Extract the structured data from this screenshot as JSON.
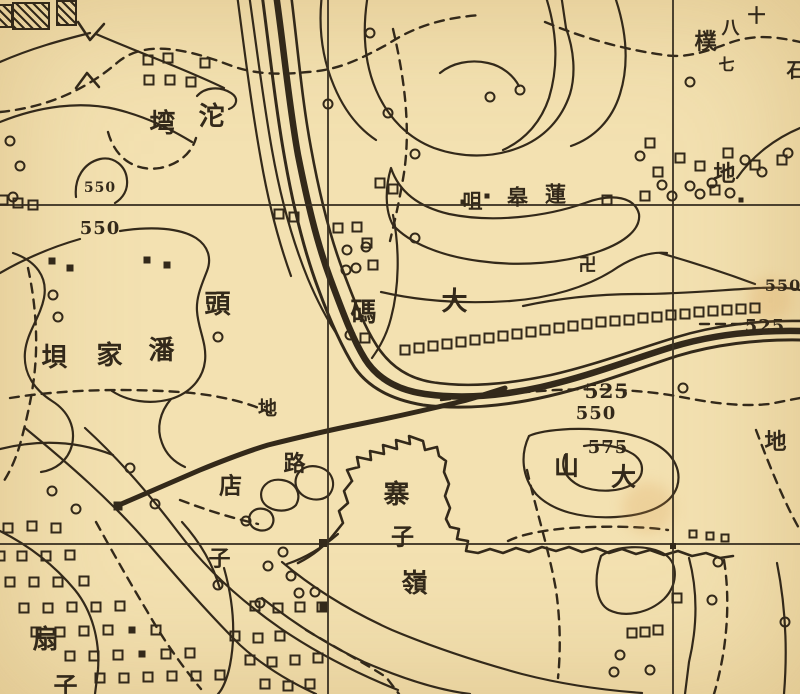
{
  "map": {
    "colors": {
      "paper": "#f3e1b1",
      "ink": "#33291a",
      "stain": "#d99a4e"
    },
    "grid": {
      "verticals": [
        {
          "x": 328
        },
        {
          "x": 673
        }
      ],
      "horizontals": [
        {
          "y": 205
        },
        {
          "y": 544
        }
      ]
    },
    "labels": [
      {
        "name": "label-tuo",
        "text": "沱",
        "x": 212,
        "y": 117,
        "size": 26,
        "rot": -5
      },
      {
        "name": "label-wan",
        "text": "塆",
        "x": 163,
        "y": 124,
        "size": 26,
        "rot": -12
      },
      {
        "name": "elev-550-a",
        "text": "550",
        "x": 100,
        "y": 188,
        "size": 14,
        "rot": -10
      },
      {
        "name": "elev-550-b",
        "text": "550",
        "x": 100,
        "y": 229,
        "size": 18,
        "rot": -6
      },
      {
        "name": "label-pan",
        "text": "潘",
        "x": 162,
        "y": 351,
        "size": 26,
        "rot": 0
      },
      {
        "name": "label-jia",
        "text": "家",
        "x": 110,
        "y": 356,
        "size": 26,
        "rot": 0
      },
      {
        "name": "label-ba",
        "text": "垻",
        "x": 55,
        "y": 358,
        "size": 26,
        "rot": 0
      },
      {
        "name": "label-tou",
        "text": "頭",
        "x": 218,
        "y": 305,
        "size": 26,
        "rot": 0
      },
      {
        "name": "label-ma",
        "text": "碼",
        "x": 364,
        "y": 313,
        "size": 26,
        "rot": 0
      },
      {
        "name": "label-da",
        "text": "大",
        "x": 455,
        "y": 302,
        "size": 26,
        "rot": 22
      },
      {
        "name": "label-lian",
        "text": "蓮",
        "x": 556,
        "y": 194,
        "size": 21,
        "rot": 0
      },
      {
        "name": "label-gao",
        "text": "皋",
        "x": 518,
        "y": 197,
        "size": 21,
        "rot": 0
      },
      {
        "name": "label-zui",
        "text": "咀",
        "x": 473,
        "y": 201,
        "size": 20,
        "rot": 0
      },
      {
        "name": "temple-swastika",
        "text": "卍",
        "x": 588,
        "y": 266,
        "size": 18,
        "rot": 0
      },
      {
        "name": "label-di-ne",
        "text": "地",
        "x": 725,
        "y": 174,
        "size": 22,
        "rot": -6
      },
      {
        "name": "label-shi",
        "text": "十",
        "x": 757,
        "y": 17,
        "size": 18,
        "rot": 0
      },
      {
        "name": "label-ba8",
        "text": "八",
        "x": 731,
        "y": 29,
        "size": 18,
        "rot": 0
      },
      {
        "name": "label-pu",
        "text": "樸",
        "x": 706,
        "y": 42,
        "size": 22,
        "rot": 0
      },
      {
        "name": "label-qi",
        "text": "七",
        "x": 727,
        "y": 65,
        "size": 16,
        "rot": 0
      },
      {
        "name": "label-edge-char",
        "text": "石",
        "x": 797,
        "y": 70,
        "size": 20,
        "rot": 0
      },
      {
        "name": "label-di-center",
        "text": "地",
        "x": 268,
        "y": 409,
        "size": 19,
        "rot": -12
      },
      {
        "name": "label-lu",
        "text": "路",
        "x": 295,
        "y": 464,
        "size": 22,
        "rot": 0
      },
      {
        "name": "label-dian",
        "text": "店",
        "x": 231,
        "y": 486,
        "size": 23,
        "rot": 0
      },
      {
        "name": "label-zi-dian",
        "text": "子",
        "x": 220,
        "y": 559,
        "size": 22,
        "rot": 0
      },
      {
        "name": "label-zhai",
        "text": "寨",
        "x": 397,
        "y": 495,
        "size": 26,
        "rot": 0
      },
      {
        "name": "label-zi-zhai",
        "text": "子",
        "x": 403,
        "y": 537,
        "size": 23,
        "rot": 0
      },
      {
        "name": "label-ling",
        "text": "嶺",
        "x": 415,
        "y": 584,
        "size": 26,
        "rot": 0
      },
      {
        "name": "label-shan",
        "text": "山",
        "x": 567,
        "y": 466,
        "size": 25,
        "rot": 100
      },
      {
        "name": "label-da-shan",
        "text": "大",
        "x": 624,
        "y": 477,
        "size": 25,
        "rot": 100
      },
      {
        "name": "elev-575",
        "text": "575",
        "x": 608,
        "y": 448,
        "size": 18,
        "rot": -14
      },
      {
        "name": "elev-550-c",
        "text": "550",
        "x": 596,
        "y": 414,
        "size": 18,
        "rot": -10
      },
      {
        "name": "elev-525-a",
        "text": "525",
        "x": 607,
        "y": 391,
        "size": 20,
        "rot": -6
      },
      {
        "name": "elev-525-b",
        "text": "525",
        "x": 765,
        "y": 327,
        "size": 18,
        "rot": -14
      },
      {
        "name": "elev-550-d",
        "text": "550",
        "x": 783,
        "y": 286,
        "size": 16,
        "rot": -18
      },
      {
        "name": "label-fan",
        "text": "扇",
        "x": 46,
        "y": 640,
        "size": 26,
        "rot": 0
      },
      {
        "name": "label-zi-fan",
        "text": "子",
        "x": 66,
        "y": 686,
        "size": 24,
        "rot": 0
      },
      {
        "name": "label-di-se",
        "text": "地",
        "x": 776,
        "y": 442,
        "size": 22,
        "rot": 96
      }
    ],
    "symbols": {
      "circles": [
        {
          "x": 10,
          "y": 141
        },
        {
          "x": 20,
          "y": 166
        },
        {
          "x": 13,
          "y": 197
        },
        {
          "x": 53,
          "y": 295
        },
        {
          "x": 58,
          "y": 317
        },
        {
          "x": 218,
          "y": 337
        },
        {
          "x": 347,
          "y": 250
        },
        {
          "x": 366,
          "y": 247
        },
        {
          "x": 346,
          "y": 270
        },
        {
          "x": 356,
          "y": 268
        },
        {
          "x": 350,
          "y": 335
        },
        {
          "x": 415,
          "y": 238
        },
        {
          "x": 490,
          "y": 97
        },
        {
          "x": 520,
          "y": 90
        },
        {
          "x": 370,
          "y": 33
        },
        {
          "x": 328,
          "y": 104
        },
        {
          "x": 388,
          "y": 113
        },
        {
          "x": 415,
          "y": 154
        },
        {
          "x": 690,
          "y": 82
        },
        {
          "x": 640,
          "y": 156
        },
        {
          "x": 662,
          "y": 185
        },
        {
          "x": 690,
          "y": 186
        },
        {
          "x": 712,
          "y": 183
        },
        {
          "x": 745,
          "y": 160
        },
        {
          "x": 762,
          "y": 172
        },
        {
          "x": 788,
          "y": 153
        },
        {
          "x": 672,
          "y": 196
        },
        {
          "x": 700,
          "y": 194
        },
        {
          "x": 730,
          "y": 193
        },
        {
          "x": 683,
          "y": 388
        },
        {
          "x": 283,
          "y": 552
        },
        {
          "x": 291,
          "y": 576
        },
        {
          "x": 268,
          "y": 566
        },
        {
          "x": 299,
          "y": 593
        },
        {
          "x": 52,
          "y": 491
        },
        {
          "x": 76,
          "y": 509
        },
        {
          "x": 130,
          "y": 468
        },
        {
          "x": 155,
          "y": 504
        },
        {
          "x": 218,
          "y": 585
        },
        {
          "x": 260,
          "y": 603
        },
        {
          "x": 315,
          "y": 592
        },
        {
          "x": 620,
          "y": 655
        },
        {
          "x": 650,
          "y": 670
        },
        {
          "x": 785,
          "y": 622
        },
        {
          "x": 614,
          "y": 672
        },
        {
          "x": 718,
          "y": 562
        },
        {
          "x": 712,
          "y": 600
        },
        {
          "x": 246,
          "y": 521
        }
      ],
      "squares": [
        {
          "x": 148,
          "y": 60
        },
        {
          "x": 168,
          "y": 58
        },
        {
          "x": 149,
          "y": 80
        },
        {
          "x": 170,
          "y": 80
        },
        {
          "x": 191,
          "y": 82
        },
        {
          "x": 205,
          "y": 63
        },
        {
          "x": 3,
          "y": 200
        },
        {
          "x": 18,
          "y": 203
        },
        {
          "x": 33,
          "y": 205
        },
        {
          "x": 338,
          "y": 228
        },
        {
          "x": 357,
          "y": 227
        },
        {
          "x": 367,
          "y": 243
        },
        {
          "x": 373,
          "y": 265
        },
        {
          "x": 365,
          "y": 338
        },
        {
          "x": 279,
          "y": 214
        },
        {
          "x": 294,
          "y": 217
        },
        {
          "x": 380,
          "y": 183
        },
        {
          "x": 393,
          "y": 189
        },
        {
          "x": 405,
          "y": 350
        },
        {
          "x": 419,
          "y": 348
        },
        {
          "x": 433,
          "y": 346
        },
        {
          "x": 447,
          "y": 344
        },
        {
          "x": 461,
          "y": 342
        },
        {
          "x": 475,
          "y": 340
        },
        {
          "x": 489,
          "y": 338
        },
        {
          "x": 503,
          "y": 336
        },
        {
          "x": 517,
          "y": 334
        },
        {
          "x": 531,
          "y": 332
        },
        {
          "x": 545,
          "y": 330
        },
        {
          "x": 559,
          "y": 328
        },
        {
          "x": 573,
          "y": 326
        },
        {
          "x": 587,
          "y": 324
        },
        {
          "x": 601,
          "y": 322
        },
        {
          "x": 615,
          "y": 321
        },
        {
          "x": 629,
          "y": 320
        },
        {
          "x": 643,
          "y": 318
        },
        {
          "x": 657,
          "y": 317
        },
        {
          "x": 671,
          "y": 315
        },
        {
          "x": 685,
          "y": 314
        },
        {
          "x": 699,
          "y": 312
        },
        {
          "x": 713,
          "y": 311
        },
        {
          "x": 727,
          "y": 310
        },
        {
          "x": 741,
          "y": 309
        },
        {
          "x": 755,
          "y": 308
        },
        {
          "x": 650,
          "y": 143
        },
        {
          "x": 680,
          "y": 158
        },
        {
          "x": 658,
          "y": 172
        },
        {
          "x": 700,
          "y": 166
        },
        {
          "x": 728,
          "y": 153
        },
        {
          "x": 607,
          "y": 200
        },
        {
          "x": 645,
          "y": 196
        },
        {
          "x": 755,
          "y": 165
        },
        {
          "x": 782,
          "y": 160
        },
        {
          "x": 715,
          "y": 190
        },
        {
          "x": 8,
          "y": 528
        },
        {
          "x": 32,
          "y": 526
        },
        {
          "x": 56,
          "y": 528
        },
        {
          "x": 0,
          "y": 556
        },
        {
          "x": 22,
          "y": 556
        },
        {
          "x": 46,
          "y": 556
        },
        {
          "x": 70,
          "y": 555
        },
        {
          "x": 10,
          "y": 582
        },
        {
          "x": 34,
          "y": 582
        },
        {
          "x": 58,
          "y": 582
        },
        {
          "x": 84,
          "y": 581
        },
        {
          "x": 24,
          "y": 608
        },
        {
          "x": 48,
          "y": 608
        },
        {
          "x": 72,
          "y": 607
        },
        {
          "x": 96,
          "y": 607
        },
        {
          "x": 120,
          "y": 606
        },
        {
          "x": 36,
          "y": 632
        },
        {
          "x": 60,
          "y": 632
        },
        {
          "x": 84,
          "y": 631
        },
        {
          "x": 108,
          "y": 630
        },
        {
          "x": 156,
          "y": 630
        },
        {
          "x": 70,
          "y": 656
        },
        {
          "x": 94,
          "y": 656
        },
        {
          "x": 118,
          "y": 655
        },
        {
          "x": 166,
          "y": 654
        },
        {
          "x": 190,
          "y": 653
        },
        {
          "x": 100,
          "y": 678
        },
        {
          "x": 124,
          "y": 678
        },
        {
          "x": 148,
          "y": 677
        },
        {
          "x": 172,
          "y": 676
        },
        {
          "x": 196,
          "y": 676
        },
        {
          "x": 220,
          "y": 675
        },
        {
          "x": 255,
          "y": 606
        },
        {
          "x": 278,
          "y": 608
        },
        {
          "x": 300,
          "y": 607
        },
        {
          "x": 322,
          "y": 607
        },
        {
          "x": 235,
          "y": 636
        },
        {
          "x": 258,
          "y": 638
        },
        {
          "x": 280,
          "y": 636
        },
        {
          "x": 250,
          "y": 660
        },
        {
          "x": 272,
          "y": 662
        },
        {
          "x": 295,
          "y": 660
        },
        {
          "x": 318,
          "y": 658
        },
        {
          "x": 265,
          "y": 684
        },
        {
          "x": 288,
          "y": 686
        },
        {
          "x": 310,
          "y": 684
        },
        {
          "x": 632,
          "y": 633
        },
        {
          "x": 645,
          "y": 632
        },
        {
          "x": 658,
          "y": 630
        },
        {
          "x": 677,
          "y": 598
        },
        {
          "x": 693,
          "y": 534,
          "s": 5
        },
        {
          "x": 710,
          "y": 536,
          "s": 5
        },
        {
          "x": 725,
          "y": 538,
          "s": 5
        },
        {
          "x": 52,
          "y": 261,
          "filled": true
        },
        {
          "x": 70,
          "y": 268,
          "filled": true
        },
        {
          "x": 147,
          "y": 260,
          "filled": true
        },
        {
          "x": 167,
          "y": 265,
          "filled": true
        },
        {
          "x": 132,
          "y": 630,
          "filled": true
        },
        {
          "x": 142,
          "y": 654,
          "filled": true
        },
        {
          "x": 463,
          "y": 202,
          "filled": true,
          "s": 5
        },
        {
          "x": 487,
          "y": 196,
          "filled": true,
          "s": 5
        },
        {
          "x": 741,
          "y": 200,
          "filled": true,
          "s": 5
        },
        {
          "x": 323,
          "y": 543,
          "filled": true,
          "s": 8
        },
        {
          "x": 673,
          "y": 546,
          "filled": true,
          "s": 6
        },
        {
          "x": 118,
          "y": 506,
          "filled": true,
          "s": 9,
          "rot": 25
        },
        {
          "x": 323,
          "y": 607,
          "filled": true,
          "s": 7
        }
      ],
      "buildings": [
        {
          "x": 12,
          "y": 2,
          "w": 34,
          "h": 24,
          "rot": -12
        },
        {
          "x": 56,
          "y": 0,
          "w": 17,
          "h": 22,
          "rot": 8
        },
        {
          "x": -5,
          "y": 4,
          "w": 14,
          "h": 20,
          "rot": -25
        }
      ],
      "stains": [
        {
          "x": 648,
          "y": 508,
          "d": 52
        },
        {
          "x": 770,
          "y": 300,
          "d": 44
        }
      ]
    }
  }
}
